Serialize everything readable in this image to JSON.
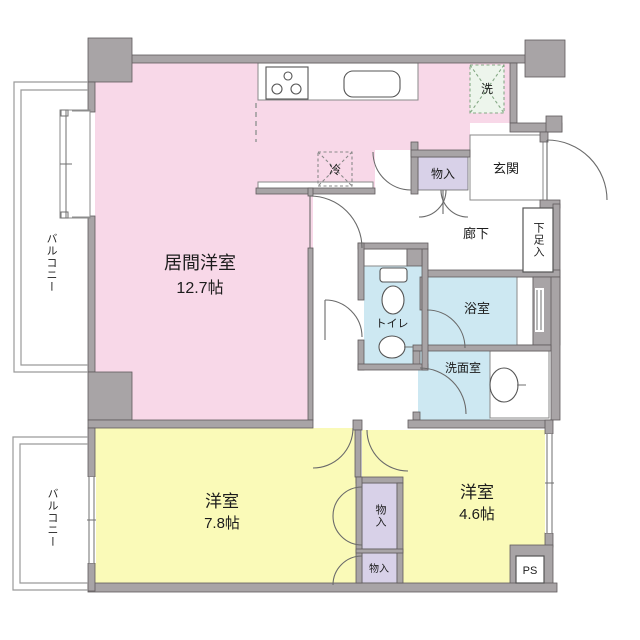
{
  "colors": {
    "pink": "#f8d8e8",
    "yellow": "#fafab8",
    "blue": "#cde8f2",
    "purple": "#d8d1e8",
    "wall": "#a8a4a6",
    "washer_fill": "#edf5ec",
    "washer_stroke": "#85a985",
    "balcony": "#9a9a9a"
  },
  "rooms": {
    "living": {
      "label": "居間洋室",
      "area": "12.7帖"
    },
    "bedroom_78": {
      "label": "洋室",
      "area": "7.8帖"
    },
    "bedroom_46": {
      "label": "洋室",
      "area": "4.6帖"
    },
    "balcony_top": {
      "label": "バルコニー"
    },
    "balcony_bottom": {
      "label": "バルコニー"
    },
    "entrance": {
      "label": "玄関"
    },
    "hallway": {
      "label": "廊下"
    },
    "shoe_cabinet": {
      "label": "下足入"
    },
    "toilet": {
      "label": "トイレ"
    },
    "bathroom": {
      "label": "浴室"
    },
    "washroom": {
      "label": "洗面室"
    },
    "storage_hall": {
      "label": "物入"
    },
    "storage_bedroom_upper": {
      "label": "物入"
    },
    "storage_bedroom_lower": {
      "label": "物入"
    },
    "pipe_space": {
      "label": "PS"
    }
  },
  "appliances": {
    "washer": {
      "label": "洗"
    },
    "refrigerator": {
      "label": "冷"
    }
  }
}
